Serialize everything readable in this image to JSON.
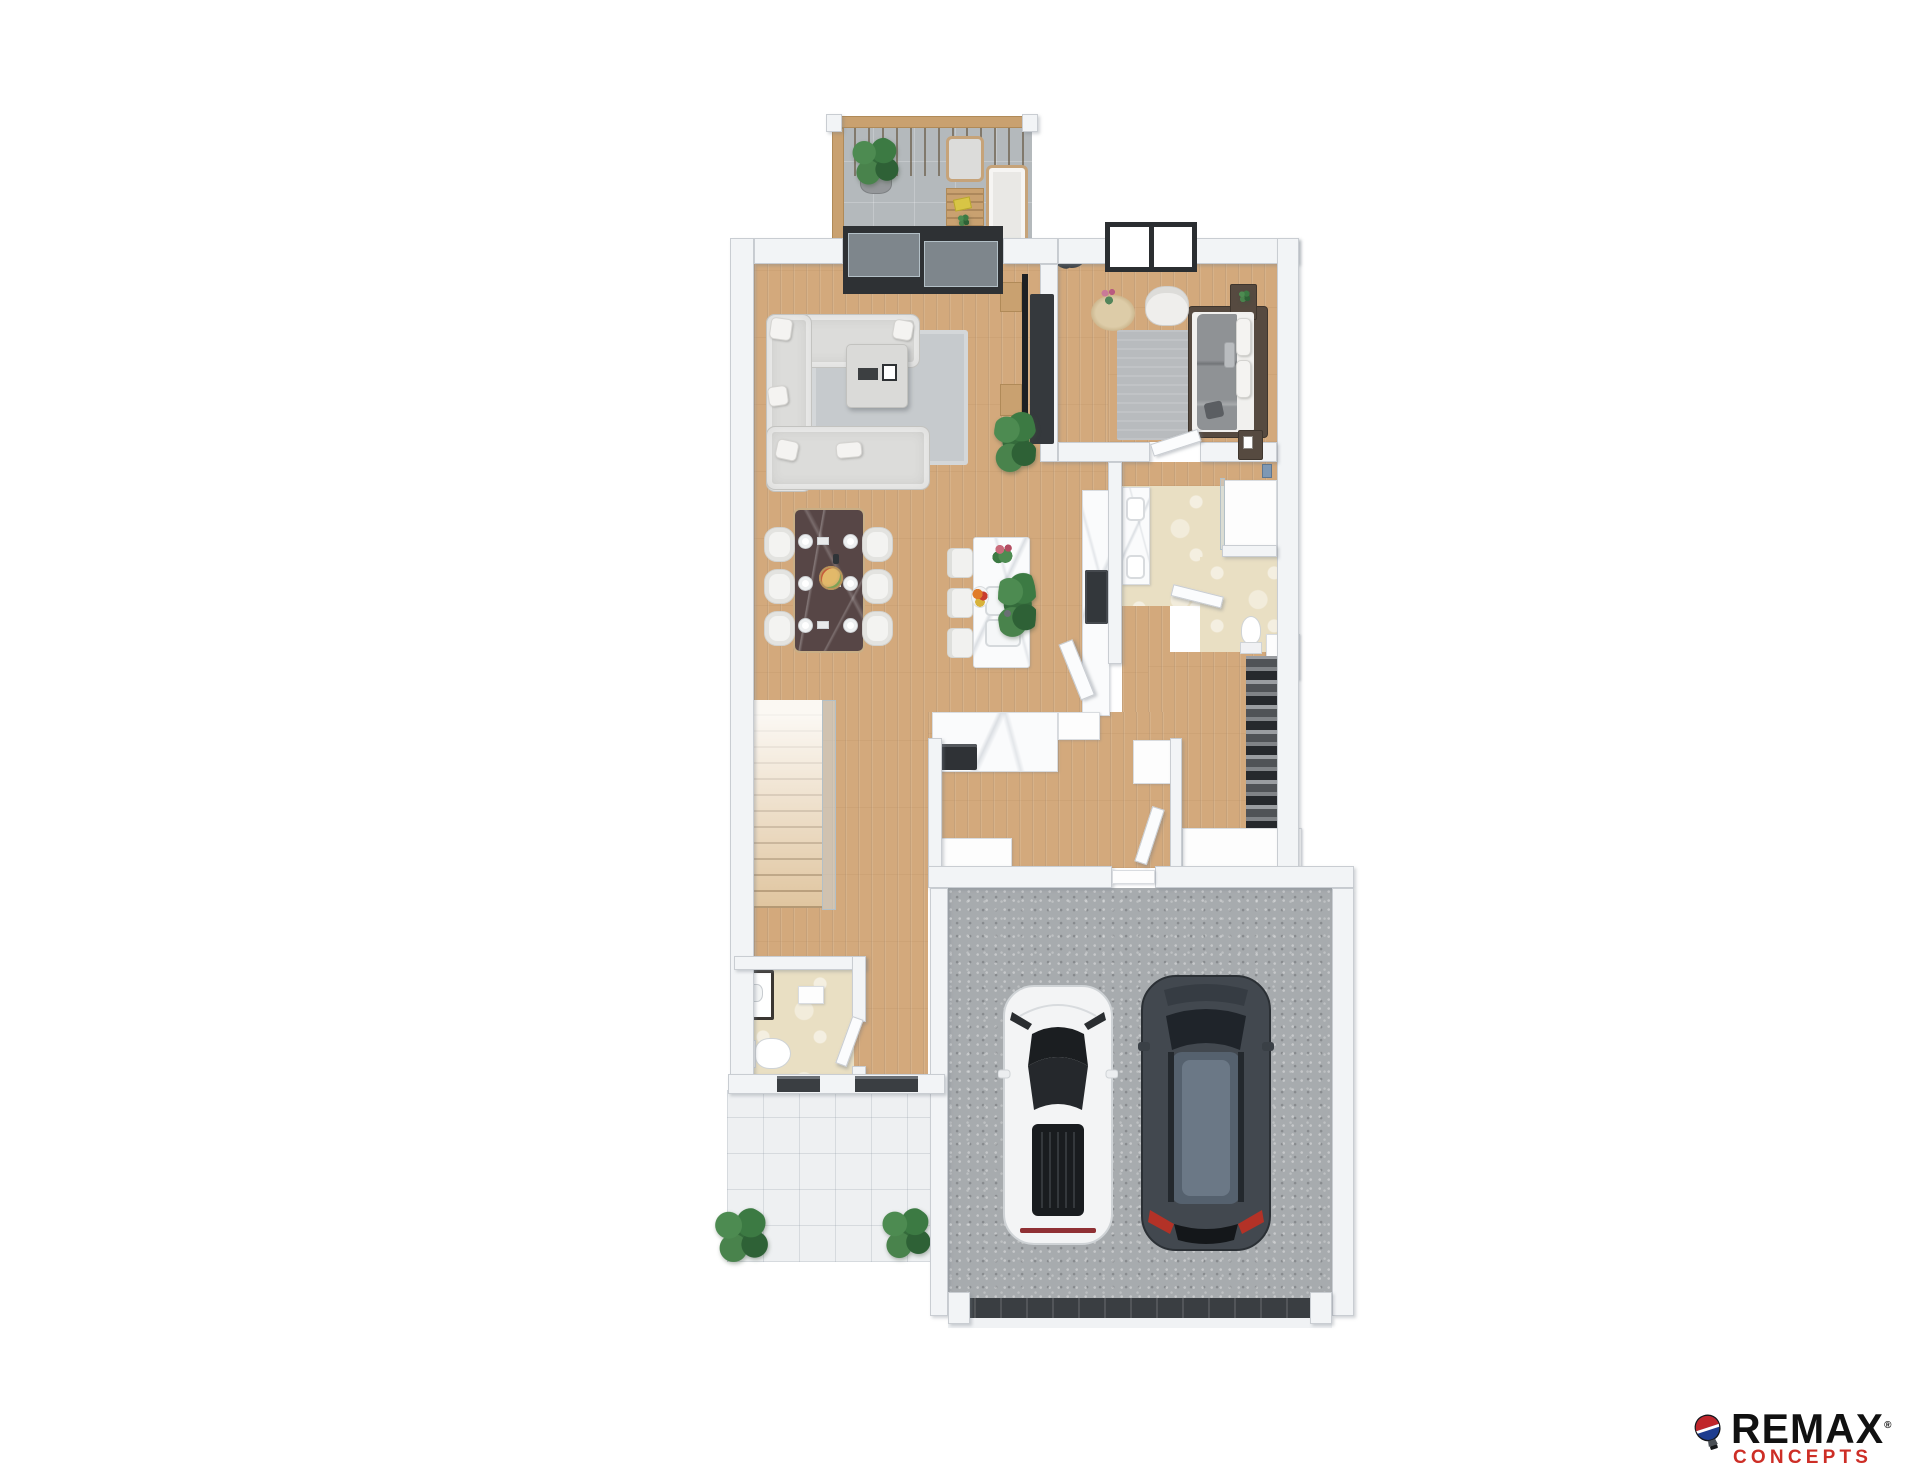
{
  "logo": {
    "brand": "REMAX",
    "registered_mark": "®",
    "sub_brand": "CONCEPTS",
    "brand_color": "#111111",
    "sub_brand_color": "#cd2e26",
    "balloon_top_color": "#c0262b",
    "balloon_bottom_color": "#1e3d8f"
  },
  "palette": {
    "wall": "#f2f4f6",
    "wood": "#d3a97c",
    "wood-furniture": "#c9a170",
    "balcony-tile": "#b4b9bc",
    "porch-tile": "#eef0f2",
    "bath-tile": "#e9dfc3",
    "concrete": "#a7abae",
    "rug-gray": "#c6cacd",
    "sofa": "#dcdcda",
    "marble": "#fafbfc",
    "dark-furniture": "#35393d",
    "dining-table": "#574646",
    "bed-frame": "#564a40",
    "blanket": "#8f9295",
    "glass": "#c3c7ca",
    "brand-ink": "#111111",
    "brand-red": "#cd2e26"
  },
  "scene": {
    "type": "3d-floor-plan-render",
    "rooms": [
      "balcony",
      "living-room",
      "bedroom",
      "bathroom",
      "toilet-room",
      "walk-in-closet",
      "kitchen",
      "dining-area",
      "stairway",
      "entry-hall",
      "powder-room",
      "mudroom",
      "garage",
      "front-porch"
    ],
    "vehicles": [
      "white-sports-car",
      "dark-suv"
    ]
  }
}
